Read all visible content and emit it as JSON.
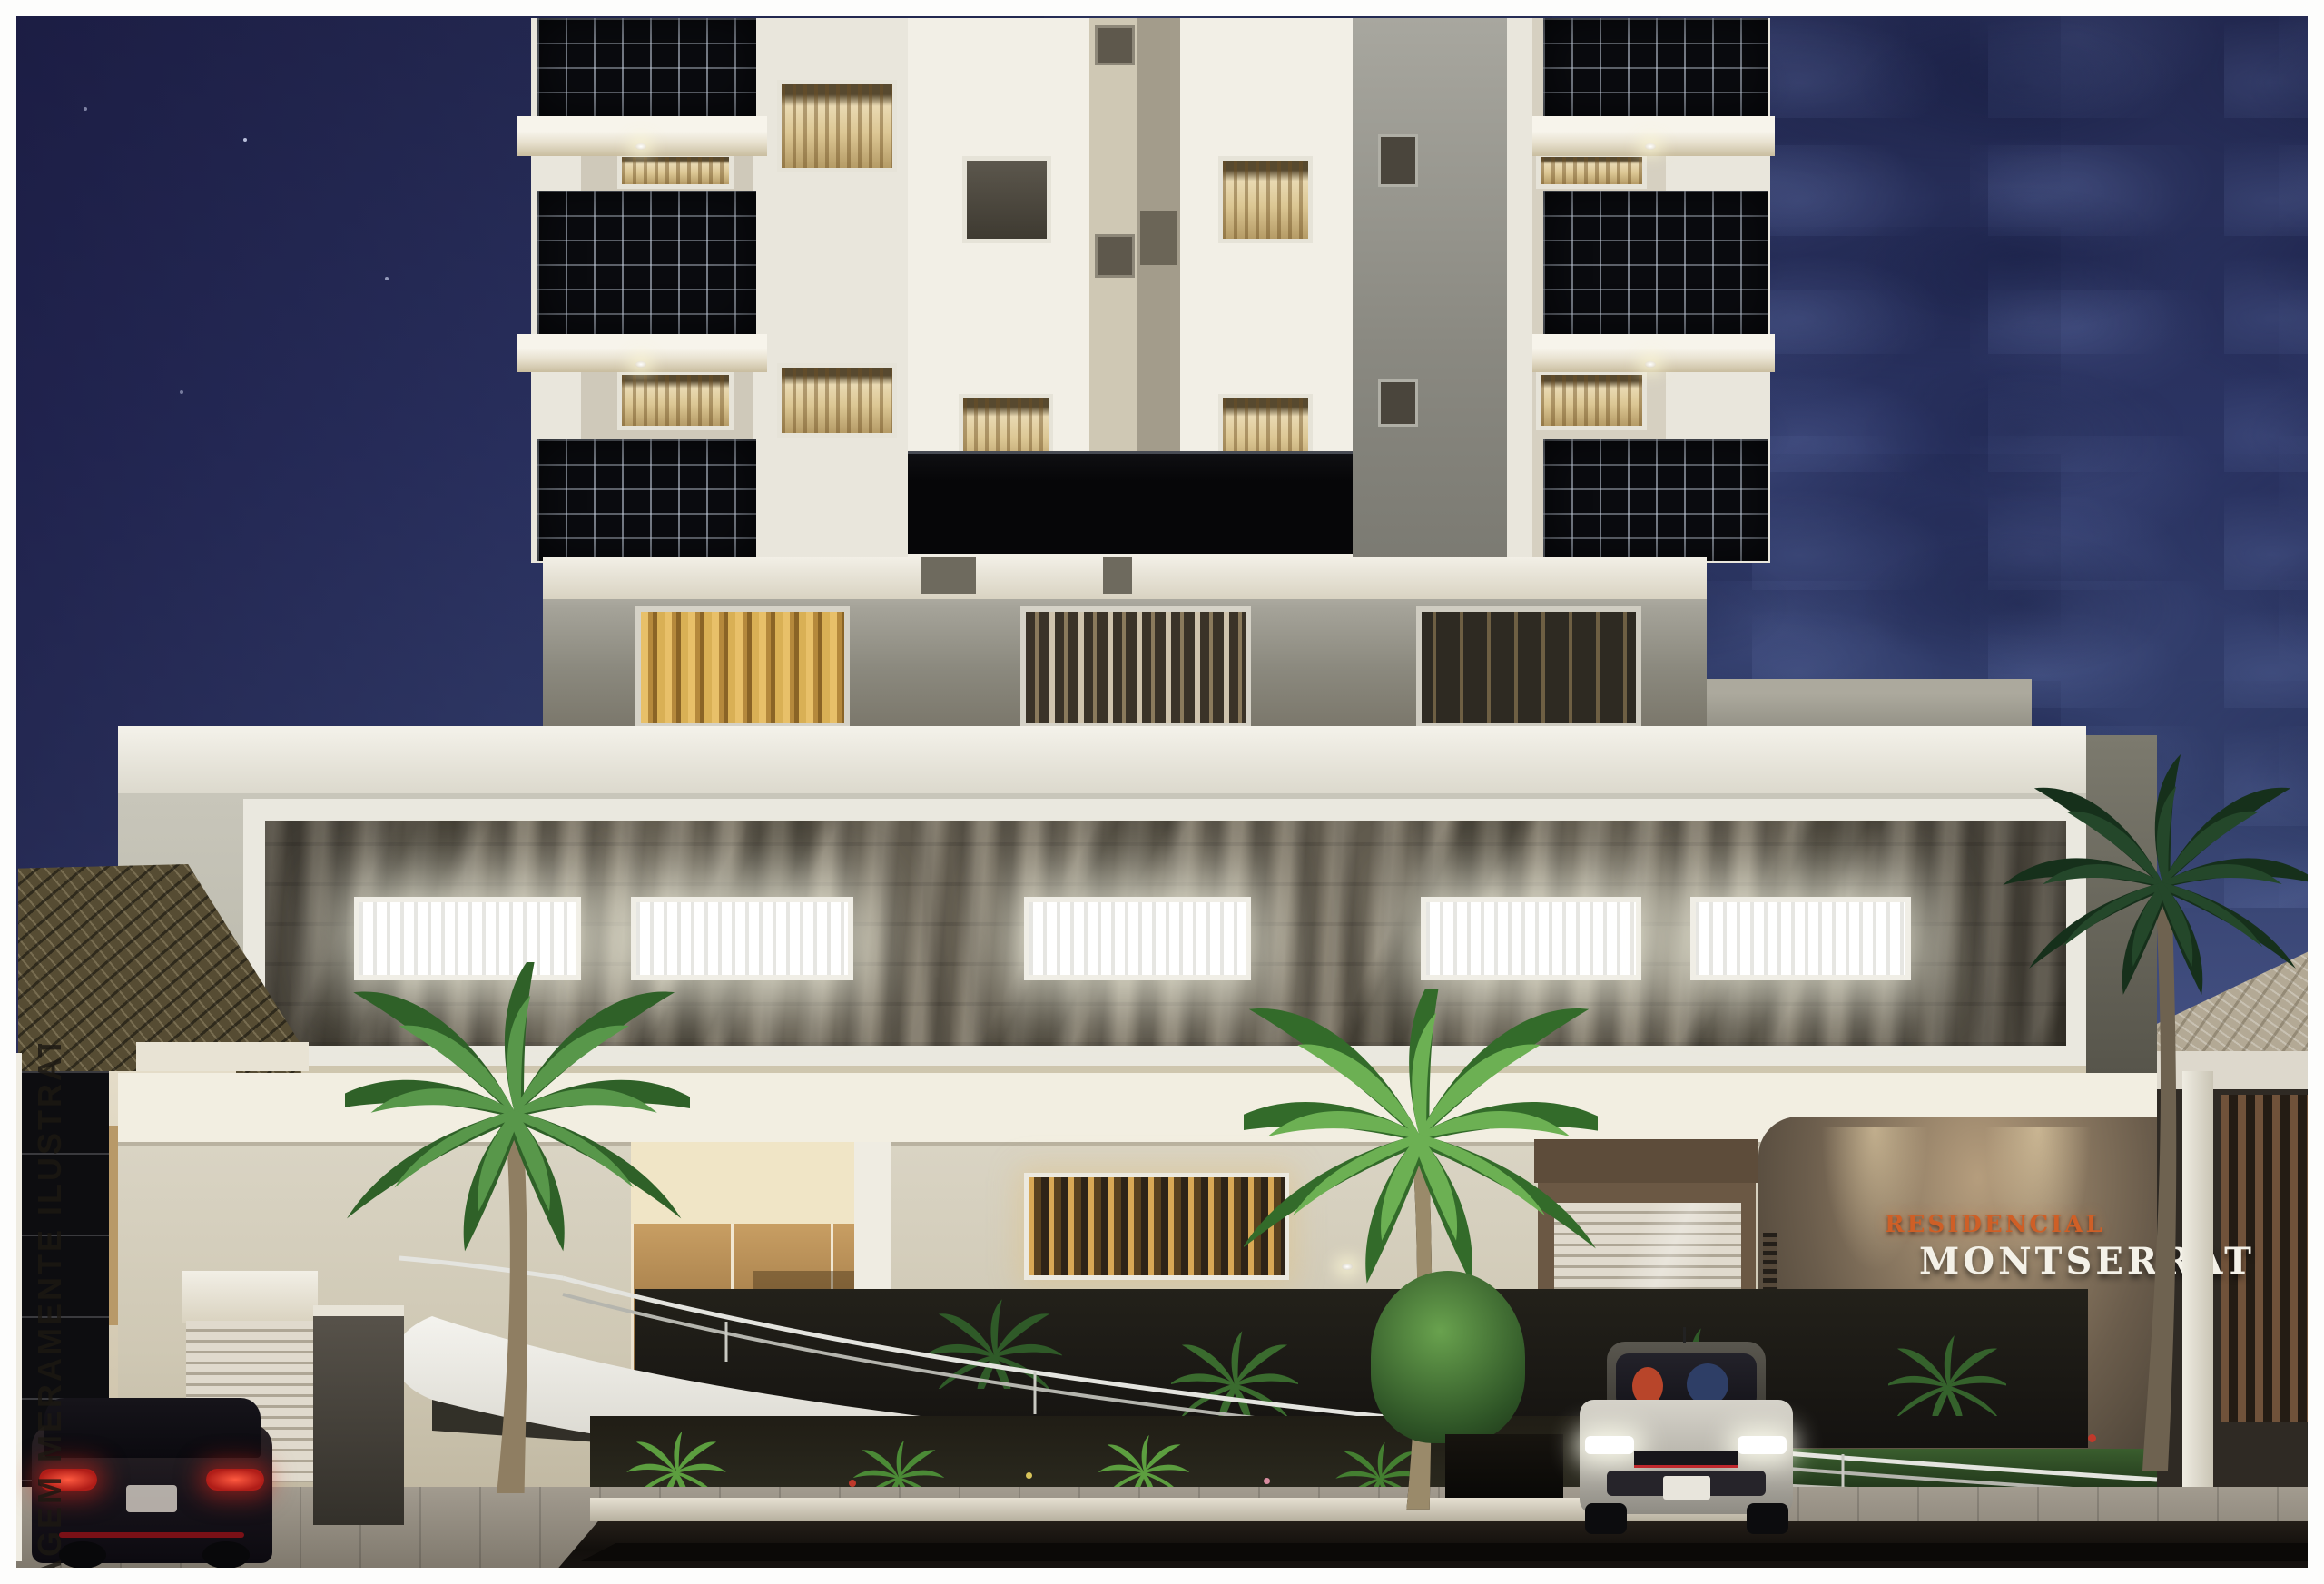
{
  "meta": {
    "description": "Photorealistic 3D architectural rendering of the Residencial Montserrat apartment building facade at dusk",
    "time_of_day": "dusk"
  },
  "watermark": {
    "text": "IMAGEM MERAMENTE ILUSTRATIVA"
  },
  "sign": {
    "line1": "RESIDENCIAL",
    "line2": "MONTSERRAT",
    "line1_color": "#cf5f26",
    "line2_color": "#f4f1e8",
    "wall_color": "#6b5d4c"
  },
  "palette": {
    "sky_top": "#232950",
    "sky_bottom": "#6d78a5",
    "facade_white": "#e9e6dc",
    "balcony_glass": "#0a0b0f",
    "textured_panel": "#7b7363",
    "window_glow": "#ffffff",
    "warm_curtain": "#e9d9b2",
    "bronze_entrance": "#a37c48",
    "street": "#18140f",
    "frame": "#fdfdfc"
  },
  "scene": {
    "palms": 3,
    "vehicles": {
      "left": "dark SUV, tail lights lit",
      "right": "silver sedan, headlights on, two occupants"
    },
    "lit_window_count_podium": 5
  }
}
